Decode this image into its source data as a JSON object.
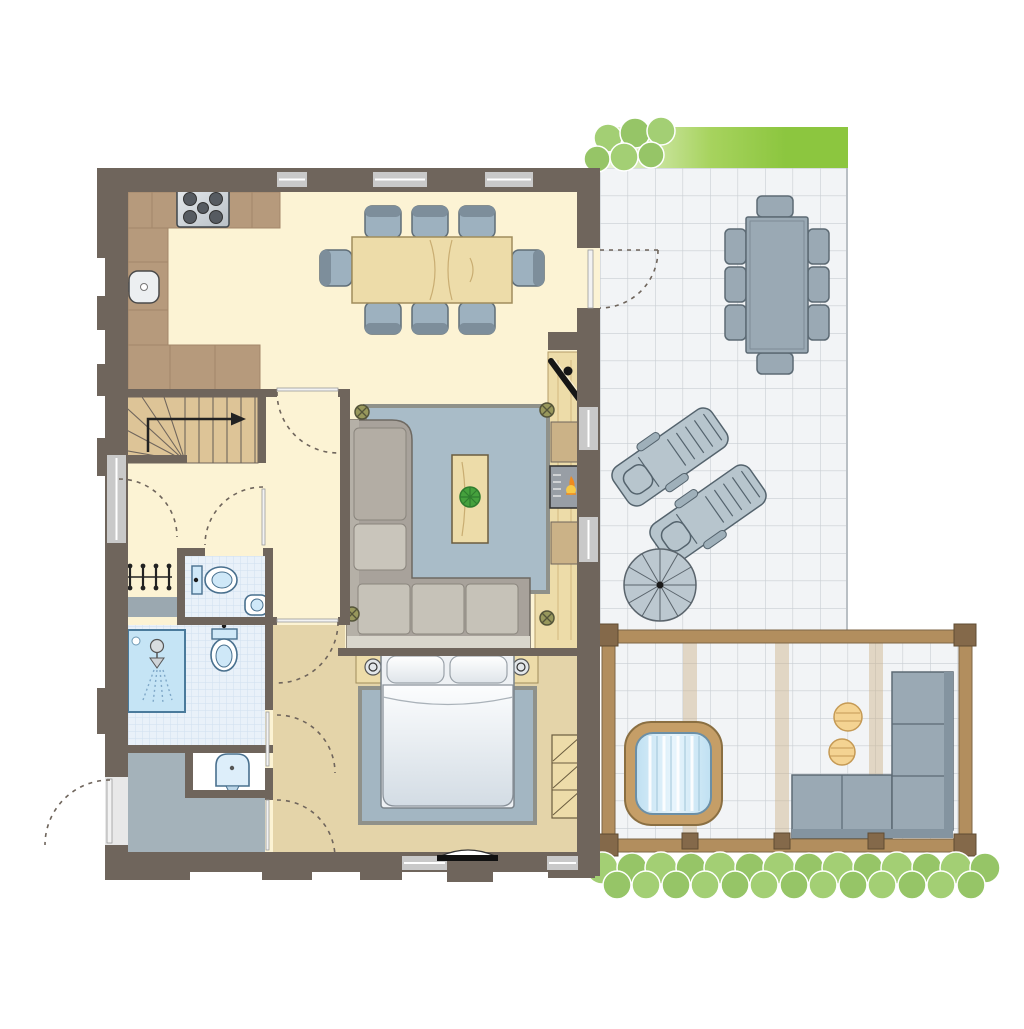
{
  "meta": {
    "kind": "architectural-floor-plan",
    "view": "top-down ground floor plan of a holiday home with patio, pergola terrace and hot tub",
    "visible_text": "none"
  },
  "palette": {
    "wall": "#6f655c",
    "window": "#c9c9c9",
    "cream": "#fcf3d4",
    "tan": "#e4d4a9",
    "counter": "#b69a7c",
    "counter_line": "#a3876a",
    "wood": "#eddca9",
    "wood_line": "#c9ad72",
    "stair": "#ddc497",
    "tile_blue": "#e9f1f9",
    "tile_line": "#cfe0f0",
    "shower": "#c5e4f5",
    "fixture": "#49708e",
    "fixture_fill": "#cfe8f8",
    "entry": "#a4b2ba",
    "mat": "#9ba8b0",
    "rug": "#a9bcc8",
    "bedroom_rug": "#a3b6c2",
    "rug_border": "#8f918a",
    "sofa": "#a8a29b",
    "sofa_cushion": "#c6c2b8",
    "sofa_light": "#d9d6cc",
    "chair": "#9db1bf",
    "chair_dark": "#7d8e9b",
    "outline": "#4f5a62",
    "patio_tile": "#f2f4f6",
    "patio_line": "#c9ced3",
    "green": "#8cc63f",
    "green_light": "#eef6e1",
    "bush": "#a3cf74",
    "bush2": "#96c567",
    "pergola": "#b28e5e",
    "post": "#84694a",
    "tub_wood": "#c59e67",
    "water": "#cfeaf7",
    "side_table": "#f4d392",
    "outdoor": "#9aa9b4",
    "outdoor_dark": "#5c6a74",
    "outdoor_back": "#8494a0",
    "stove_burner": "#565b61",
    "flame": "#ef8b1f",
    "flame_core": "#f7c948",
    "plant": "#45a13d",
    "rosette": "#98985c",
    "arc": "#6f655c",
    "door_leaf": "#f2f2f2"
  },
  "rooms": [
    {
      "id": "kitchen-dining",
      "floor": "cream",
      "items": [
        "l-shaped-kitchen-counter",
        "stove-5-burners",
        "kitchen-sink",
        "dining-table-wood",
        "dining-chairs-x8"
      ]
    },
    {
      "id": "living-area",
      "floor": "cream-and-wood",
      "items": [
        "corner-sofa",
        "area-rug",
        "coffee-table-with-plant",
        "tv-corner-unit",
        "fireplace-stove",
        "cabinets-x2",
        "floor-rosettes-x4"
      ]
    },
    {
      "id": "hallway",
      "floor": "cream",
      "items": [
        "l-shaped-stairs-with-up-arrow",
        "coat-rack",
        "doormat"
      ]
    },
    {
      "id": "wc",
      "floor": "blue-tile",
      "items": [
        "toilet",
        "corner-washbasin"
      ]
    },
    {
      "id": "bathroom",
      "floor": "blue-tile",
      "items": [
        "shower",
        "toilet",
        "washbasin"
      ]
    },
    {
      "id": "entry",
      "floor": "gray",
      "items": [
        "front-door",
        "washbasin-niche"
      ]
    },
    {
      "id": "bedroom",
      "floor": "tan",
      "items": [
        "double-bed",
        "pillows-x2",
        "nightstands-x2",
        "bedside-lamps-x2",
        "area-rug",
        "dresser",
        "door-threshold"
      ]
    },
    {
      "id": "patio",
      "floor": "tile-grid",
      "items": [
        "outdoor-dining-table",
        "outdoor-chairs-x8",
        "sun-loungers-x2",
        "spiral-staircase",
        "hedge-strip",
        "bush-cluster"
      ]
    },
    {
      "id": "pergola-terrace",
      "floor": "tile-grid",
      "items": [
        "wood-frame-pergola",
        "hot-tub",
        "round-side-tables-x2",
        "outdoor-corner-sofa",
        "hedge-row"
      ]
    }
  ],
  "counts": {
    "dining_chairs": 8,
    "outdoor_chairs": 8,
    "stove_burners": 5,
    "sun_loungers": 2,
    "toilets": 2,
    "washbasins": 3,
    "door_swing_arcs": 8,
    "floor_rosettes": 4
  }
}
